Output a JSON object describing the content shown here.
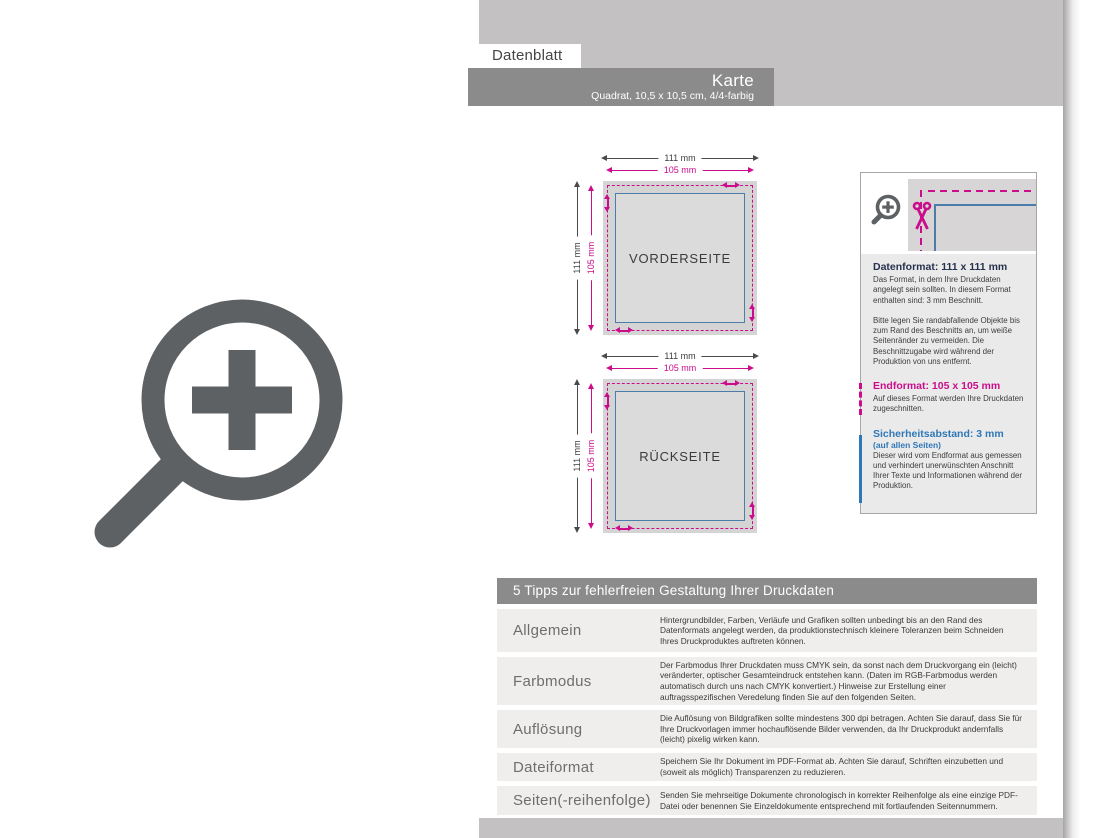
{
  "header": {
    "tab": "Datenblatt",
    "title": "Karte",
    "subtitle": "Quadrat, 10,5 x 10,5 cm, 4/4-farbig"
  },
  "dims": {
    "outer": "111 mm",
    "inner": "105 mm"
  },
  "diagrams": {
    "front": {
      "label": "VORDERSEITE"
    },
    "back": {
      "label": "RÜCKSEITE"
    }
  },
  "infobox": {
    "datenformat": {
      "heading": "Datenformat: 111 x 111 mm",
      "body1": "Das Format, in dem Ihre Druckdaten angelegt sein sollten. In diesem Format enthalten sind: 3 mm Beschnitt.",
      "body2": "Bitte legen Sie randabfallende Objekte bis zum Rand des Beschnitts an, um weiße Seitenränder zu vermeiden. Die Beschnittzugabe wird während der Produktion von uns entfernt."
    },
    "endformat": {
      "heading": "Endformat: 105 x 105 mm",
      "body": "Auf dieses Format werden Ihre Druckdaten zugeschnitten."
    },
    "sicherheitsabstand": {
      "heading": "Sicherheitsabstand: 3 mm",
      "subheading": "(auf allen Seiten)",
      "body": "Dieser wird vom Endformat aus gemessen und verhindert unerwünschten Anschnitt Ihrer Texte und Informationen während der Produktion."
    }
  },
  "tips": {
    "title": "5 Tipps zur fehlerfreien Gestaltung Ihrer Druckdaten",
    "rows": [
      {
        "label": "Allgemein",
        "text": "Hintergrundbilder, Farben, Verläufe und Grafiken sollten unbedingt bis an den Rand des Datenformats angelegt werden, da produktionstechnisch kleinere Toleranzen beim Schneiden Ihres Druckproduktes auftreten können."
      },
      {
        "label": "Farbmodus",
        "text": "Der Farbmodus Ihrer Druckdaten muss CMYK sein, da sonst nach dem Druckvorgang ein (leicht) veränderter, optischer Gesamteindruck entstehen kann. (Daten im RGB-Farbmodus werden automatisch durch uns nach CMYK konvertiert.) Hinweise zur Erstellung einer auftragsspezifischen Veredelung finden Sie auf den folgenden Seiten."
      },
      {
        "label": "Auflösung",
        "text": "Die Auflösung von Bildgrafiken sollte mindestens 300 dpi betragen. Achten Sie darauf, dass Sie für Ihre Druckvorlagen immer hochauflösende Bilder verwenden, da Ihr Druckprodukt andernfalls (leicht) pixelig wirken kann."
      },
      {
        "label": "Dateiformat",
        "text": "Speichern Sie Ihr Dokument im PDF-Format ab. Achten Sie darauf, Schriften einzubetten und (soweit als möglich) Transparenzen zu reduzieren."
      },
      {
        "label": "Seiten(-reihenfolge)",
        "text": "Senden Sie mehrseitige Dokumente chronologisch in korrekter Reihenfolge als eine einzige PDF-Datei oder benennen Sie Einzeldokumente entsprechend mit fortlaufenden Seitennummern."
      }
    ]
  },
  "icons": {
    "big": "zoom-plus-icon",
    "infobox_magnifier": "zoom-plus-icon",
    "infobox_scissors": "scissors-icon"
  },
  "colors": {
    "magenta": "#cb0d8c",
    "steel_blue": "#4b7dab",
    "navy": "#25324e",
    "info_blue": "#2f78b8",
    "bar_gray": "#8b8b8b",
    "band_gray": "#c3c1c1"
  }
}
